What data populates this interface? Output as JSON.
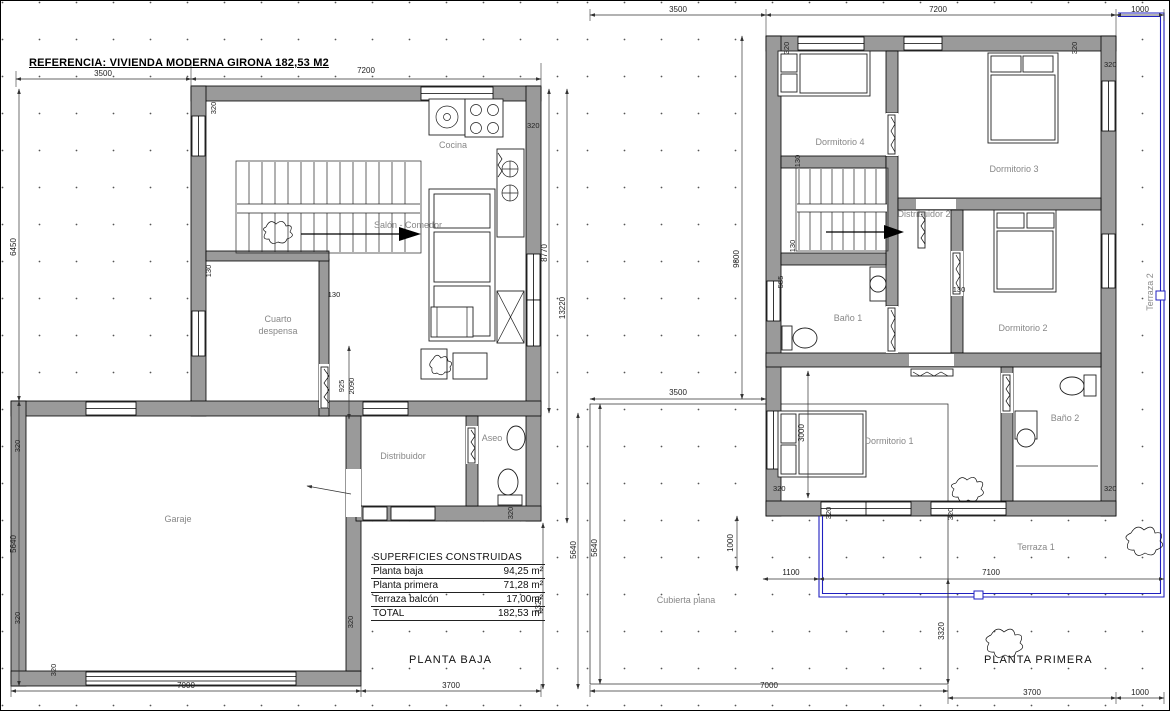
{
  "title": "REFERENCIA: VIVIENDA MODERNA GIRONA 182,53 M2",
  "planta_baja": {
    "caption": "PLANTA BAJA",
    "rooms": {
      "cocina": "Cocina",
      "salon": "Salón - Comedor",
      "cuarto": "Cuarto",
      "despensa": "despensa",
      "distribuidor": "Distribuidor",
      "aseo": "Aseo",
      "garaje": "Garaje"
    }
  },
  "planta_primera": {
    "caption": "PLANTA PRIMERA",
    "rooms": {
      "dormitorio1": "Dormitorio 1",
      "dormitorio2": "Dormitorio 2",
      "dormitorio3": "Dormitorio 3",
      "dormitorio4": "Dormitorio 4",
      "distribuidor2": "Distribuidor 2",
      "bano1": "Baño 1",
      "bano2": "Baño 2",
      "terraza1": "Terraza 1",
      "terraza2": "Terraza 2",
      "cubierta": "Cubierta plana"
    }
  },
  "dims": {
    "d3500": "3500",
    "d7200": "7200",
    "d1000": "1000",
    "d6450": "6450",
    "d5640": "5640",
    "d8770": "8770",
    "d13220": "13220",
    "d3320": "3320",
    "d7000": "7000",
    "d3700": "3700",
    "d9800": "9800",
    "d3000": "3000",
    "d1100": "1100",
    "d7100": "7100",
    "w320": "320",
    "w130": "130",
    "w585": "585",
    "w925": "925",
    "w2090": "2090"
  },
  "areas_table": {
    "title": "SUPERFICIES CONSTRUIDAS",
    "rows": [
      {
        "label": "Planta baja",
        "value": "94,25 m²"
      },
      {
        "label": "Planta primera",
        "value": "71,28 m²"
      },
      {
        "label": "Terraza balcón",
        "value": "17,00m²"
      },
      {
        "label": "TOTAL",
        "value": "182,53 m²"
      }
    ]
  },
  "colors": {
    "wall": "#9a9a9a",
    "railing": "#2020c0"
  }
}
